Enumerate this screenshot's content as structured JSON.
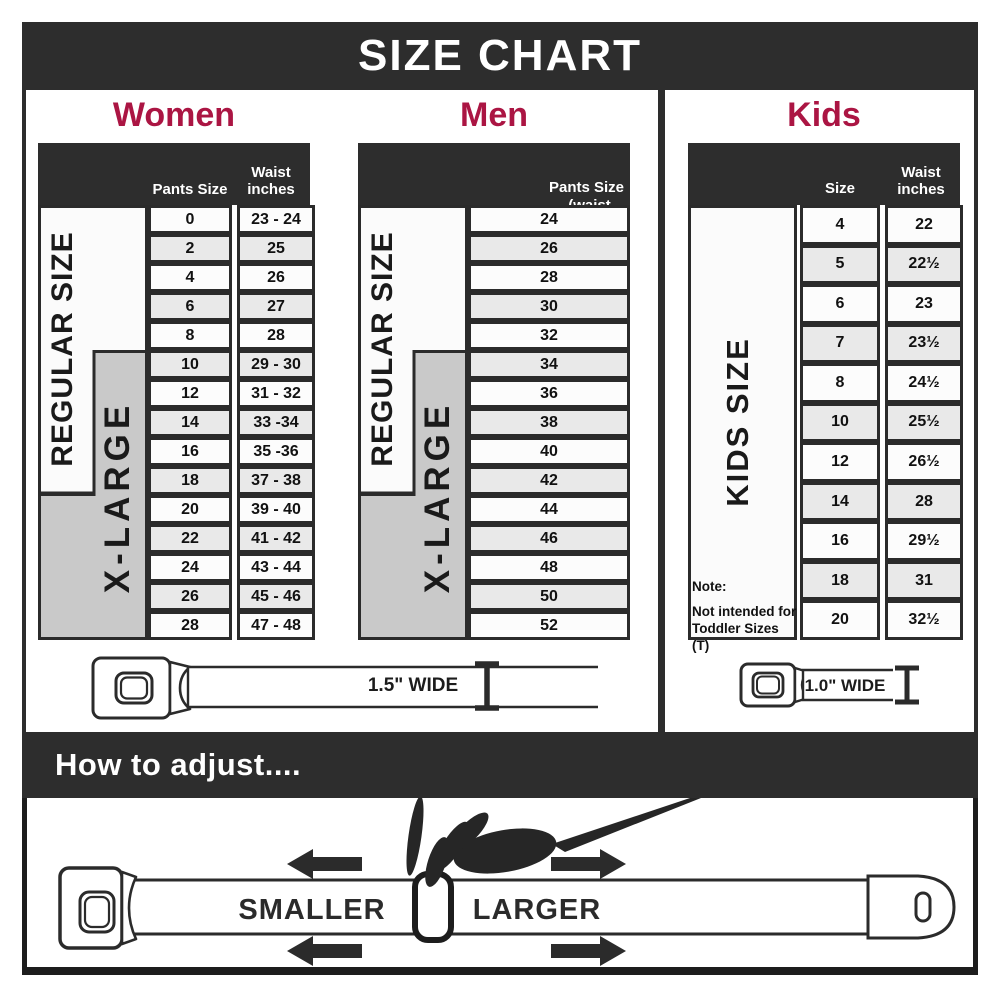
{
  "title": "SIZE CHART",
  "colors": {
    "accent": "#ab1543",
    "dark": "#2d2d2d",
    "row_alt": "#e9e9e9",
    "xlarge_gray": "#c9c9c9"
  },
  "sections": {
    "women": {
      "heading": "Women",
      "col_headers": [
        "Pants Size",
        "Waist inches"
      ],
      "size_labels": {
        "regular": "REGULAR SIZE",
        "xlarge": "X-LARGE"
      },
      "rows": [
        [
          "0",
          "23 - 24"
        ],
        [
          "2",
          "25"
        ],
        [
          "4",
          "26"
        ],
        [
          "6",
          "27"
        ],
        [
          "8",
          "28"
        ],
        [
          "10",
          "29 - 30"
        ],
        [
          "12",
          "31 - 32"
        ],
        [
          "14",
          "33 -34"
        ],
        [
          "16",
          "35 -36"
        ],
        [
          "18",
          "37 - 38"
        ],
        [
          "20",
          "39 - 40"
        ],
        [
          "22",
          "41 - 42"
        ],
        [
          "24",
          "43 - 44"
        ],
        [
          "26",
          "45 - 46"
        ],
        [
          "28",
          "47 - 48"
        ]
      ]
    },
    "men": {
      "heading": "Men",
      "header_lines": [
        "Pants Size",
        "(waist inches)"
      ],
      "size_labels": {
        "regular": "REGULAR SIZE",
        "xlarge": "X-LARGE"
      },
      "rows": [
        [
          "24"
        ],
        [
          "26"
        ],
        [
          "28"
        ],
        [
          "30"
        ],
        [
          "32"
        ],
        [
          "34"
        ],
        [
          "36"
        ],
        [
          "38"
        ],
        [
          "40"
        ],
        [
          "42"
        ],
        [
          "44"
        ],
        [
          "46"
        ],
        [
          "48"
        ],
        [
          "50"
        ],
        [
          "52"
        ]
      ]
    },
    "kids": {
      "heading": "Kids",
      "col_headers": [
        "Size",
        "Waist inches"
      ],
      "size_label": "KIDS SIZE",
      "note_lines": [
        "Note:",
        "Not intended for",
        "Toddler Sizes (T)"
      ],
      "rows": [
        [
          "4",
          "22"
        ],
        [
          "5",
          "22½"
        ],
        [
          "6",
          "23"
        ],
        [
          "7",
          "23½"
        ],
        [
          "8",
          "24½"
        ],
        [
          "10",
          "25½"
        ],
        [
          "12",
          "26½"
        ],
        [
          "14",
          "28"
        ],
        [
          "16",
          "29½"
        ],
        [
          "18",
          "31"
        ],
        [
          "20",
          "32½"
        ]
      ]
    }
  },
  "belts": {
    "adult_width_label": "1.5\" WIDE",
    "kids_width_label": "1.0\" WIDE"
  },
  "adjust": {
    "heading": "How to adjust....",
    "smaller_label": "SMALLER",
    "larger_label": "LARGER"
  }
}
